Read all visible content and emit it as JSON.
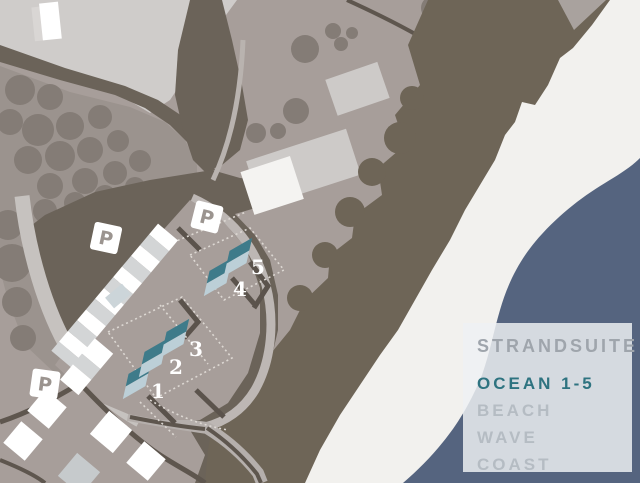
{
  "legend": {
    "title": "STRANDSUITE",
    "items": [
      {
        "label": "OCEAN 1-5",
        "color": "#2e7380",
        "active": true
      },
      {
        "label": "BEACH",
        "color": "#b5bcc3",
        "active": false
      },
      {
        "label": "WAVE",
        "color": "#b5bcc3",
        "active": false
      },
      {
        "label": "COAST",
        "color": "#b5bcc3",
        "active": false
      }
    ]
  },
  "map": {
    "units": [
      {
        "label": "1"
      },
      {
        "label": "2"
      },
      {
        "label": "3"
      },
      {
        "label": "4"
      },
      {
        "label": "5"
      }
    ],
    "parking": [
      {
        "label": "P"
      },
      {
        "label": "P"
      },
      {
        "label": "P"
      }
    ],
    "colors": {
      "ocean": "#55647f",
      "beach": "#f2f1ee",
      "ground": "#a79e9a",
      "ground_dark": "#9b938e",
      "vegetation_dark": "#6b6359",
      "dune": "#6e6557",
      "road_dark": "#5e564e",
      "road_light": "#c6c2bf",
      "building_white": "#ffffff",
      "building_gray": "#d3d5d6",
      "unit_roof_dark": "#3e7b8a",
      "unit_roof_light": "#bccfd7"
    }
  }
}
